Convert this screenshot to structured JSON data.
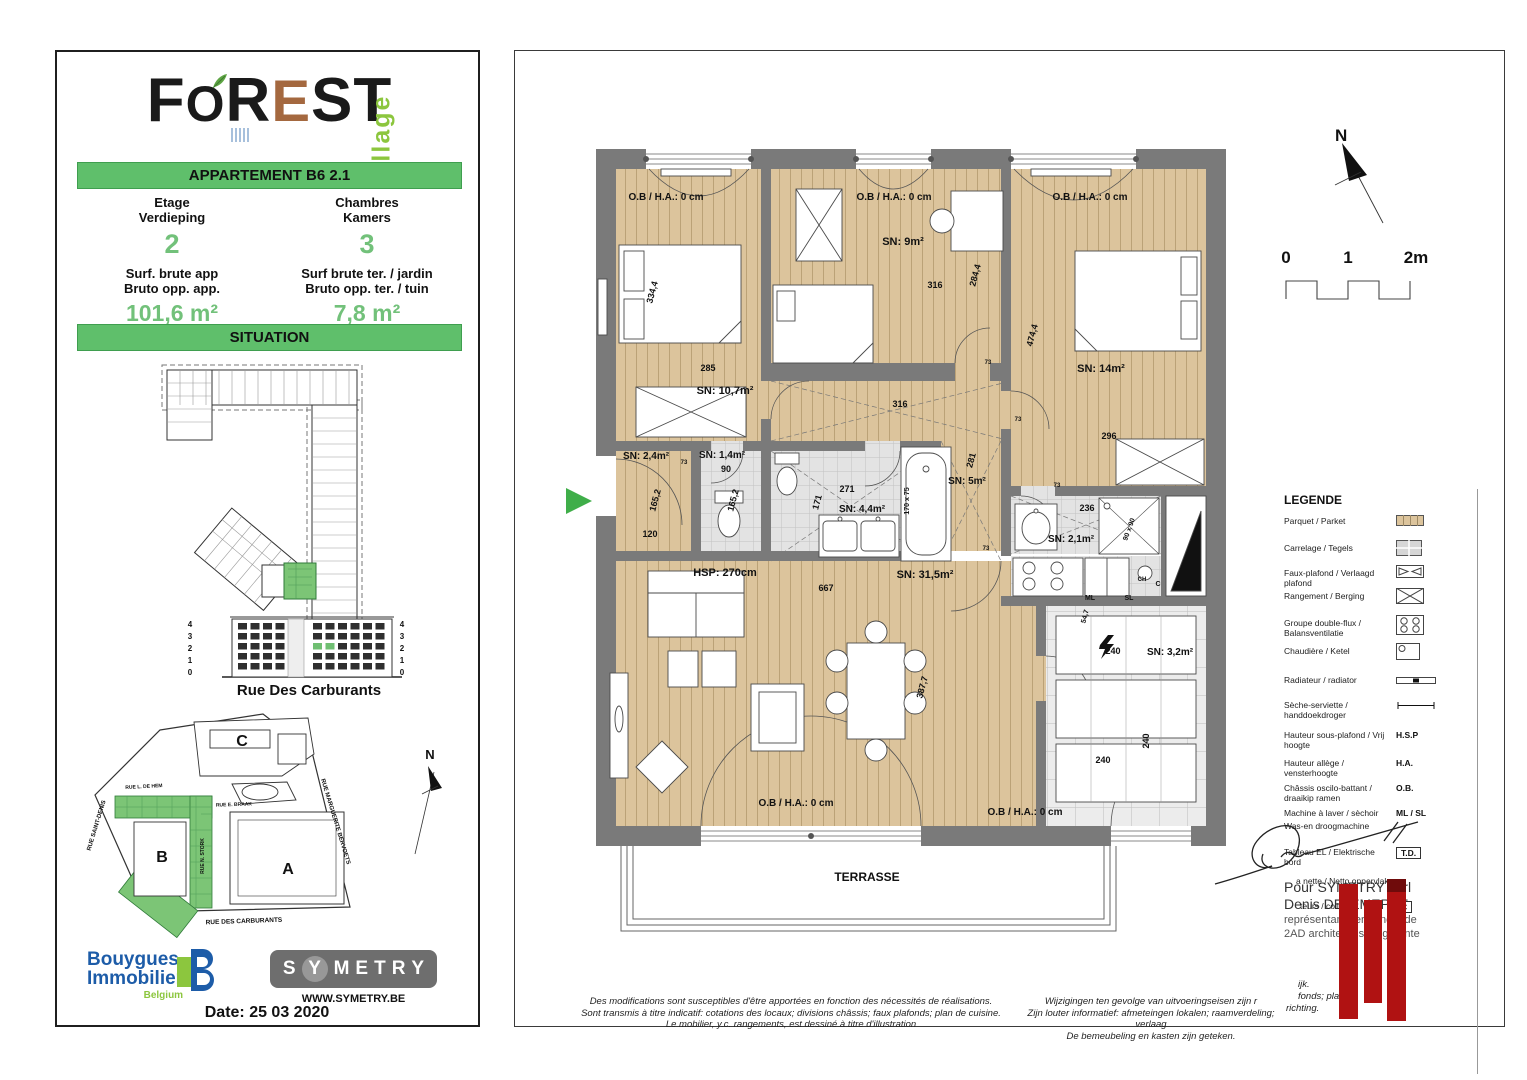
{
  "colors": {
    "banner_green": "#5fbf6b",
    "value_green": "#72c17a",
    "brand_green": "#8cc63e",
    "bouygues_blue": "#1d5ca8",
    "wall_gray": "#7a7a7a",
    "parquet": "#dcc49c",
    "tile": "#e3e3e3",
    "red_bar": "#b01212",
    "symetry_gray": "#6e6e6e",
    "logo_e_brown": "#a4683f"
  },
  "logo": {
    "letters": [
      {
        "ch": "F",
        "c": "#1a1a1a",
        "cls": ""
      },
      {
        "ch": "O",
        "c": "#1a1a1a",
        "cls": "o"
      },
      {
        "ch": "R",
        "c": "#1a1a1a",
        "cls": ""
      },
      {
        "ch": "E",
        "c": "#a4683f",
        "cls": "e"
      },
      {
        "ch": "S",
        "c": "#1a1a1a",
        "cls": ""
      },
      {
        "ch": "T",
        "c": "#1a1a1a",
        "cls": ""
      }
    ],
    "village": "village"
  },
  "apartment": {
    "banner": "APPARTEMENT B6 2.1",
    "col1": {
      "l1": "Etage",
      "l2": "Verdieping",
      "value": "2",
      "l3": "Surf. brute app",
      "l4": "Bruto opp. app.",
      "area": "101,6 m²"
    },
    "col2": {
      "l1": "Chambres",
      "l2": "Kamers",
      "value": "3",
      "l3": "Surf brute ter. / jardin",
      "l4": "Bruto opp. ter. / tuin",
      "area": "7,8 m²"
    }
  },
  "situation": {
    "banner": "SITUATION",
    "street": "Rue Des Carburants",
    "floors": [
      "4",
      "3",
      "2",
      "1",
      "0"
    ],
    "map_blocks": [
      "C",
      "B",
      "A"
    ],
    "map_streets": [
      "RUE SAINT-DENIS",
      "RUE L. DE HEM",
      "RUE E. BRAAK",
      "RUE MARGUERITE BERVOETS",
      "RUE DES CARBURANTS",
      "RUE N. STORK"
    ],
    "north": "N"
  },
  "footer": {
    "brand_top": "Bouygues",
    "brand_bottom": "Immobilier",
    "country": "Belgium",
    "symetry": "SYMETRY",
    "website": "WWW.SYMETRY.BE",
    "date": "Date: 25 03 2020"
  },
  "plan": {
    "north": "N",
    "scale_ticks": [
      "0",
      "1",
      "2m"
    ],
    "labels": [
      {
        "t": "O.B / H.A.: 0 cm",
        "x": 151,
        "y": 149,
        "s": 10
      },
      {
        "t": "O.B / H.A.: 0 cm",
        "x": 379,
        "y": 149,
        "s": 10
      },
      {
        "t": "O.B / H.A.: 0 cm",
        "x": 575,
        "y": 149,
        "s": 10
      },
      {
        "t": "334,4",
        "x": 140,
        "y": 242,
        "s": 9,
        "r": -75
      },
      {
        "t": "285",
        "x": 193,
        "y": 320,
        "s": 9
      },
      {
        "t": "SN: 10,7m²",
        "x": 210,
        "y": 343,
        "s": 11
      },
      {
        "t": "SN: 9m²",
        "x": 388,
        "y": 194,
        "s": 11
      },
      {
        "t": "316",
        "x": 420,
        "y": 237,
        "s": 9
      },
      {
        "t": "284,4",
        "x": 463,
        "y": 225,
        "s": 9,
        "r": -75
      },
      {
        "t": "316",
        "x": 385,
        "y": 356,
        "s": 9
      },
      {
        "t": "474,4",
        "x": 520,
        "y": 285,
        "s": 9,
        "r": -75
      },
      {
        "t": "SN: 14m²",
        "x": 586,
        "y": 321,
        "s": 11
      },
      {
        "t": "296",
        "x": 594,
        "y": 388,
        "s": 9
      },
      {
        "t": "SN: 5m²",
        "x": 452,
        "y": 433,
        "s": 10
      },
      {
        "t": "281",
        "x": 459,
        "y": 410,
        "s": 9,
        "r": -75
      },
      {
        "t": "SN: 2,4m²",
        "x": 131,
        "y": 408,
        "s": 10
      },
      {
        "t": "165,2",
        "x": 143,
        "y": 450,
        "s": 9,
        "r": -75
      },
      {
        "t": "120",
        "x": 135,
        "y": 486,
        "s": 9
      },
      {
        "t": "SN: 1,4m²",
        "x": 207,
        "y": 407,
        "s": 10
      },
      {
        "t": "90",
        "x": 211,
        "y": 421,
        "s": 9
      },
      {
        "t": "165,2",
        "x": 221,
        "y": 450,
        "s": 9,
        "r": -75
      },
      {
        "t": "271",
        "x": 332,
        "y": 441,
        "s": 9
      },
      {
        "t": "171",
        "x": 305,
        "y": 452,
        "s": 9,
        "r": -75
      },
      {
        "t": "SN: 4,4m²",
        "x": 347,
        "y": 461,
        "s": 10
      },
      {
        "t": "170 x 75",
        "x": 394,
        "y": 450,
        "s": 7,
        "r": -90
      },
      {
        "t": "HSP: 270cm",
        "x": 210,
        "y": 525,
        "s": 11
      },
      {
        "t": "667",
        "x": 311,
        "y": 540,
        "s": 9
      },
      {
        "t": "SN: 31,5m²",
        "x": 410,
        "y": 527,
        "s": 11
      },
      {
        "t": "236",
        "x": 572,
        "y": 460,
        "s": 9
      },
      {
        "t": "SN: 2,1m²",
        "x": 556,
        "y": 491,
        "s": 10
      },
      {
        "t": "90 x 90",
        "x": 616,
        "y": 479,
        "s": 7,
        "r": -70
      },
      {
        "t": "54,7",
        "x": 572,
        "y": 566,
        "s": 7,
        "r": -75
      },
      {
        "t": "ML",
        "x": 575,
        "y": 549,
        "s": 7
      },
      {
        "t": "SL",
        "x": 614,
        "y": 549,
        "s": 7
      },
      {
        "t": "CH",
        "x": 627,
        "y": 530,
        "s": 6
      },
      {
        "t": "C",
        "x": 643,
        "y": 535,
        "s": 7
      },
      {
        "t": "240",
        "x": 598,
        "y": 603,
        "s": 9
      },
      {
        "t": "240",
        "x": 634,
        "y": 690,
        "s": 9,
        "r": -90
      },
      {
        "t": "240",
        "x": 588,
        "y": 712,
        "s": 9
      },
      {
        "t": "SN: 3,2m²",
        "x": 655,
        "y": 604,
        "s": 10
      },
      {
        "t": "387,7",
        "x": 410,
        "y": 637,
        "s": 9,
        "r": -75
      },
      {
        "t": "O.B / H.A.: 0 cm",
        "x": 281,
        "y": 755,
        "s": 10
      },
      {
        "t": "O.B / H.A.: 0 cm",
        "x": 510,
        "y": 764,
        "s": 10
      },
      {
        "t": "TERRASSE",
        "x": 352,
        "y": 830,
        "s": 12
      },
      {
        "t": "73",
        "x": 473,
        "y": 313,
        "s": 6
      },
      {
        "t": "73",
        "x": 503,
        "y": 370,
        "s": 6
      },
      {
        "t": "73",
        "x": 542,
        "y": 436,
        "s": 6
      },
      {
        "t": "73",
        "x": 471,
        "y": 499,
        "s": 6
      },
      {
        "t": "73",
        "x": 169,
        "y": 413,
        "s": 6
      }
    ]
  },
  "signature": {
    "line1": "Pour SYMETRY sprl",
    "line2": "Denis DEJEMEPPE",
    "line3": "représentant permanent de",
    "line4": "2AD architects sprl, gérante"
  },
  "legend": {
    "title": "LEGENDE",
    "rows": [
      {
        "label": "Parquet / Parket",
        "symbol": "parquet"
      },
      {
        "label": "Carrelage / Tegels",
        "symbol": "tiles"
      },
      {
        "label": "Faux-plafond / Verlaagd plafond",
        "symbol": "bowtie"
      },
      {
        "label": "Rangement / Berging",
        "symbol": "xbox"
      },
      {
        "label": "Groupe double-flux / Balansventilatie",
        "symbol": "vents"
      },
      {
        "label": "Chaudière / Ketel",
        "symbol": "boiler"
      },
      {
        "label": "Radiateur / radiator",
        "symbol": "radiator"
      },
      {
        "label": "Sèche-serviette / handdoekdroger",
        "symbol": "towel"
      },
      {
        "label": "Hauteur sous-plafond / Vrij hoogte",
        "abbr": "H.S.P"
      },
      {
        "label": "Hauteur allège / vensterhoogte",
        "abbr": "H.A."
      },
      {
        "label": "Châssis oscilo-battant / draaikip ramen",
        "abbr": "O.B."
      },
      {
        "label": "Machine à laver / sèchoir",
        "label2": "Was-en droogmachine",
        "abbr": "ML / SL"
      },
      {
        "label": "Tableau EL / Elektrische bord",
        "abbr": "T.D.",
        "boxed": true
      },
      {
        "label": "a nette / Netto oppervlak",
        "indent": 12
      },
      {
        "label": "teurs / collector",
        "abbr": "C",
        "boxed": true,
        "indent": 16
      }
    ]
  },
  "disclaimer_fr": [
    "Des modifications sont susceptibles d'être apportées en fonction des nécessités de réalisations.",
    "Sont transmis à titre indicatif: cotations des locaux; divisions châssis; faux plafonds; plan de cuisine.",
    "Le mobilier, y.c. rangements, est dessiné à titre d'illustration"
  ],
  "disclaimer_nl": [
    "Wijzigingen ten gevolge van uitvoeringseisen zijn r",
    "Zijn louter informatief: afmeteingen lokalen; raamverdeling; verlaag",
    "De bemeubeling en kasten zijn geteken."
  ],
  "disclaimer_nl_fragments": [
    {
      "t": "ijk.",
      "x": 783,
      "y": 928
    },
    {
      "t": "fonds; plan",
      "x": 783,
      "y": 940
    },
    {
      "t": "k.",
      "x": 857,
      "y": 940
    },
    {
      "t": "richting.",
      "x": 771,
      "y": 952
    }
  ]
}
